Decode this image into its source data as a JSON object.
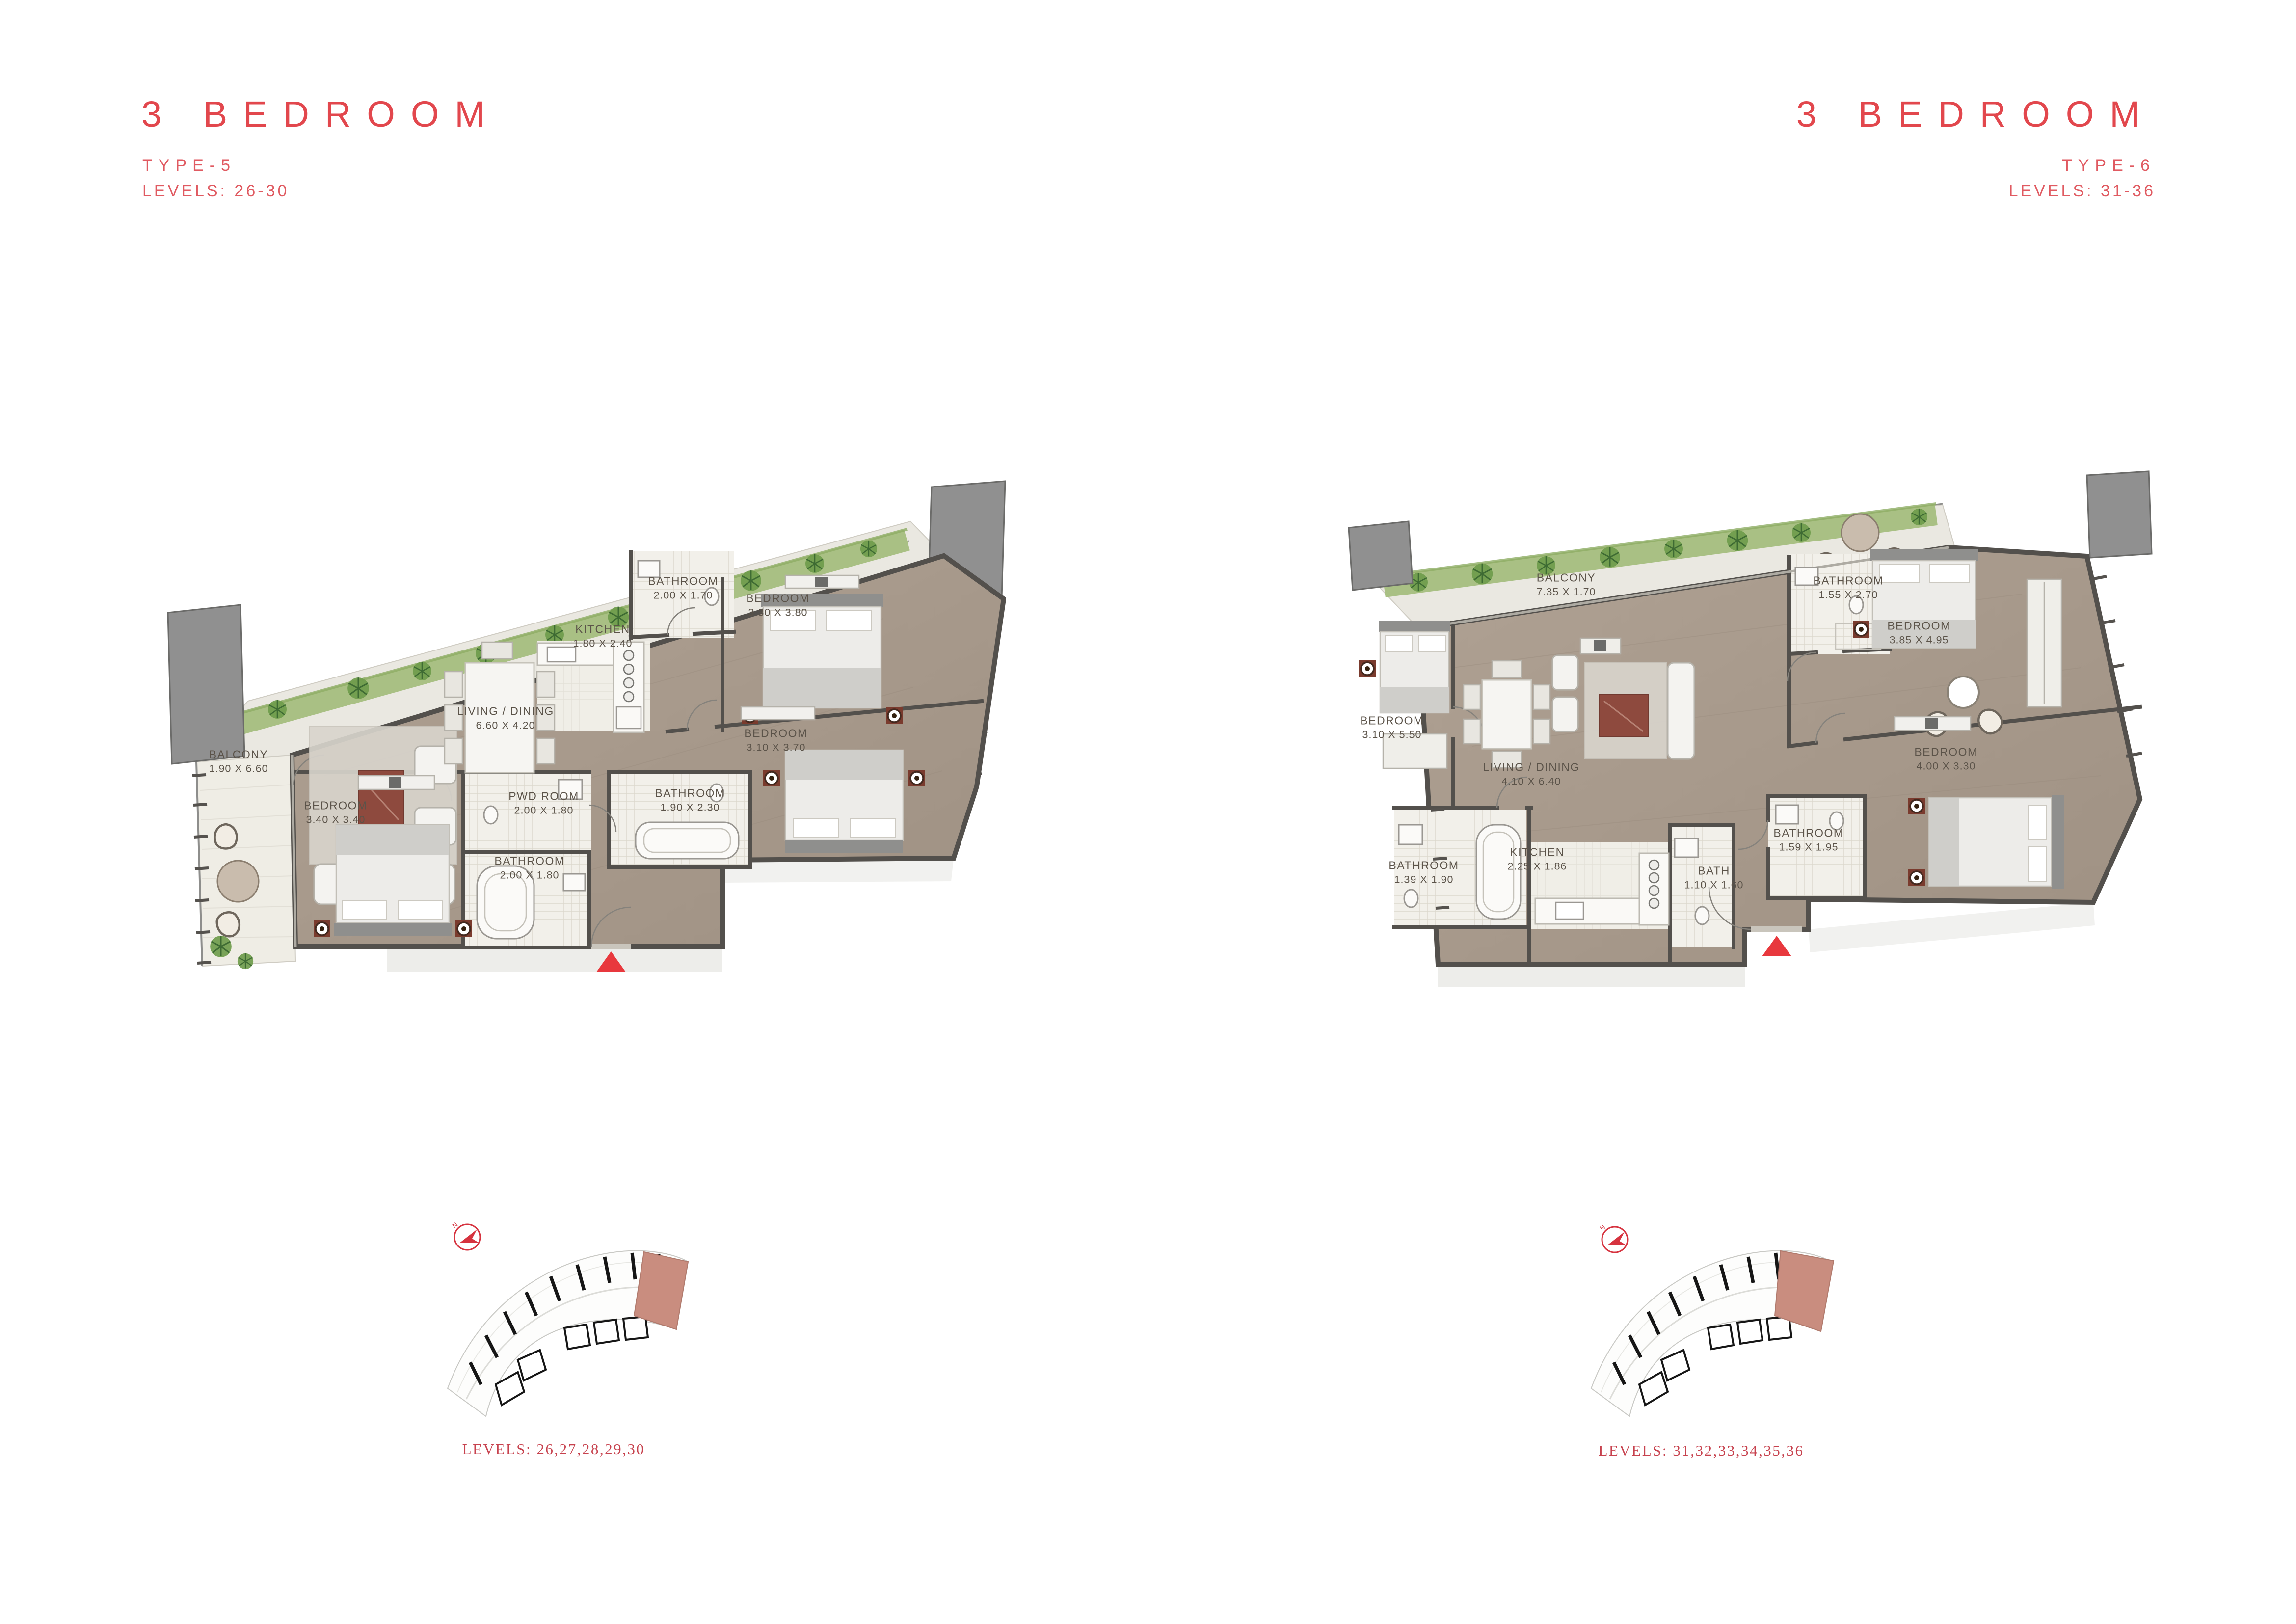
{
  "page": {
    "background": "#FFFFFF"
  },
  "panels": [
    {
      "title": "3 BEDROOM",
      "type_label": "TYPE-5",
      "levels_label": "LEVELS: 26-30",
      "key_levels_label": "LEVELS: 26,27,28,29,30",
      "north_label": "N",
      "rooms": [
        {
          "name": "BATHROOM",
          "dims": "2.00 X 1.70"
        },
        {
          "name": "KITCHEN",
          "dims": "1.80 X 2.40"
        },
        {
          "name": "BEDROOM",
          "dims": "3.30 X 3.80"
        },
        {
          "name": "LIVING / DINING",
          "dims": "6.60 X 4.20"
        },
        {
          "name": "BEDROOM",
          "dims": "3.10 X 3.70"
        },
        {
          "name": "BALCONY",
          "dims": "1.90 X 6.60"
        },
        {
          "name": "BEDROOM",
          "dims": "3.40 X 3.40"
        },
        {
          "name": "PWD ROOM",
          "dims": "2.00 X 1.80"
        },
        {
          "name": "BATHROOM",
          "dims": "2.00 X 1.80"
        },
        {
          "name": "BATHROOM",
          "dims": "1.90 X 2.30"
        }
      ]
    },
    {
      "title": "3 BEDROOM",
      "type_label": "TYPE-6",
      "levels_label": "LEVELS: 31-36",
      "key_levels_label": "LEVELS: 31,32,33,34,35,36",
      "north_label": "N",
      "rooms": [
        {
          "name": "BALCONY",
          "dims": "7.35 X 1.70"
        },
        {
          "name": "BATHROOM",
          "dims": "1.55 X 2.70"
        },
        {
          "name": "BEDROOM",
          "dims": "3.85 X 4.95"
        },
        {
          "name": "BEDROOM",
          "dims": "3.10 X 5.50"
        },
        {
          "name": "LIVING / DINING",
          "dims": "4.10 X 6.40"
        },
        {
          "name": "BEDROOM",
          "dims": "4.00 X 3.30"
        },
        {
          "name": "BATHROOM",
          "dims": "1.39 X 1.90"
        },
        {
          "name": "KITCHEN",
          "dims": "2.25 X 1.86"
        },
        {
          "name": "BATH",
          "dims": "1.10 X 1.60"
        },
        {
          "name": "BATHROOM",
          "dims": "1.59 X 1.95"
        }
      ]
    }
  ],
  "colors": {
    "accent_red": "#E2474D",
    "sub_red": "#E05A61",
    "caption_red": "#C7424E",
    "entry_marker_red": "#E8383D",
    "wood_floor": "#A89A8C",
    "tile_floor": "#F2F0EA",
    "deck_floor": "#EAE8E1",
    "wall_dark": "#53504C",
    "hedge_green": "#A9C084",
    "palm_green": "#4C7A3C",
    "key_highlight_unit": "#C98D7F"
  },
  "icons": {
    "north_arrow": "north-arrow-icon",
    "entry_triangle": "entry-triangle-icon",
    "rug": "rug-icon",
    "palm": "palm-icon"
  }
}
